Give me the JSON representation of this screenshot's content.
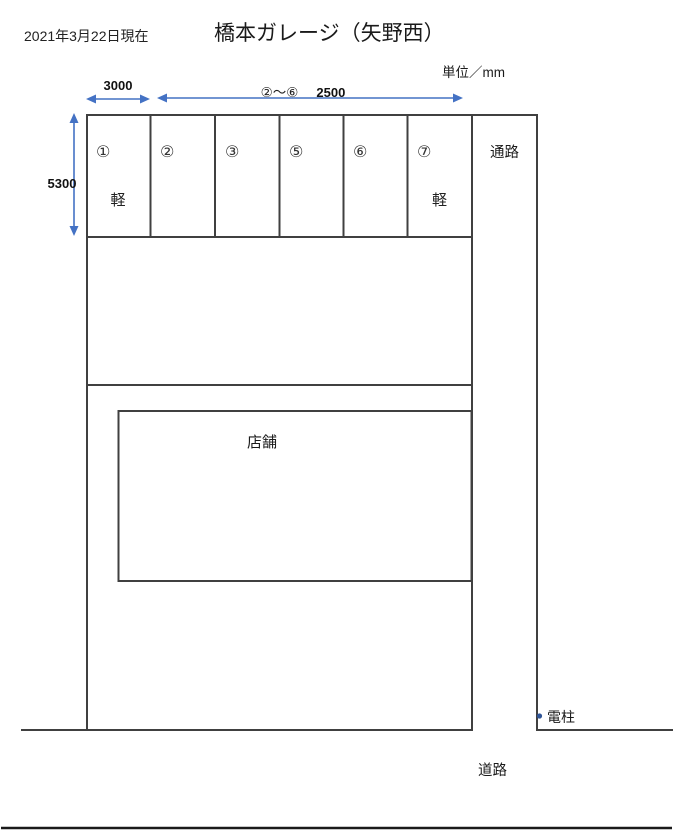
{
  "header": {
    "date": "2021年3月22日現在",
    "title": "橋本ガレージ（矢野西）",
    "unit": "単位／mm"
  },
  "dimensions": {
    "space1_width": "3000",
    "range_label": "②～⑥",
    "spaces2to6_width": "2500",
    "depth": "5300"
  },
  "spaces": [
    {
      "number": "①",
      "kei": "軽"
    },
    {
      "number": "②",
      "kei": ""
    },
    {
      "number": "③",
      "kei": ""
    },
    {
      "number": "⑤",
      "kei": ""
    },
    {
      "number": "⑥",
      "kei": ""
    },
    {
      "number": "⑦",
      "kei": "軽"
    }
  ],
  "labels": {
    "aisle": "通路",
    "store": "店舗",
    "pole": "電柱",
    "road": "道路"
  },
  "colors": {
    "line": "#404040",
    "arrow": "#4472C4",
    "pole_dot": "#2F5496",
    "road_line": "#1a1a1a"
  }
}
